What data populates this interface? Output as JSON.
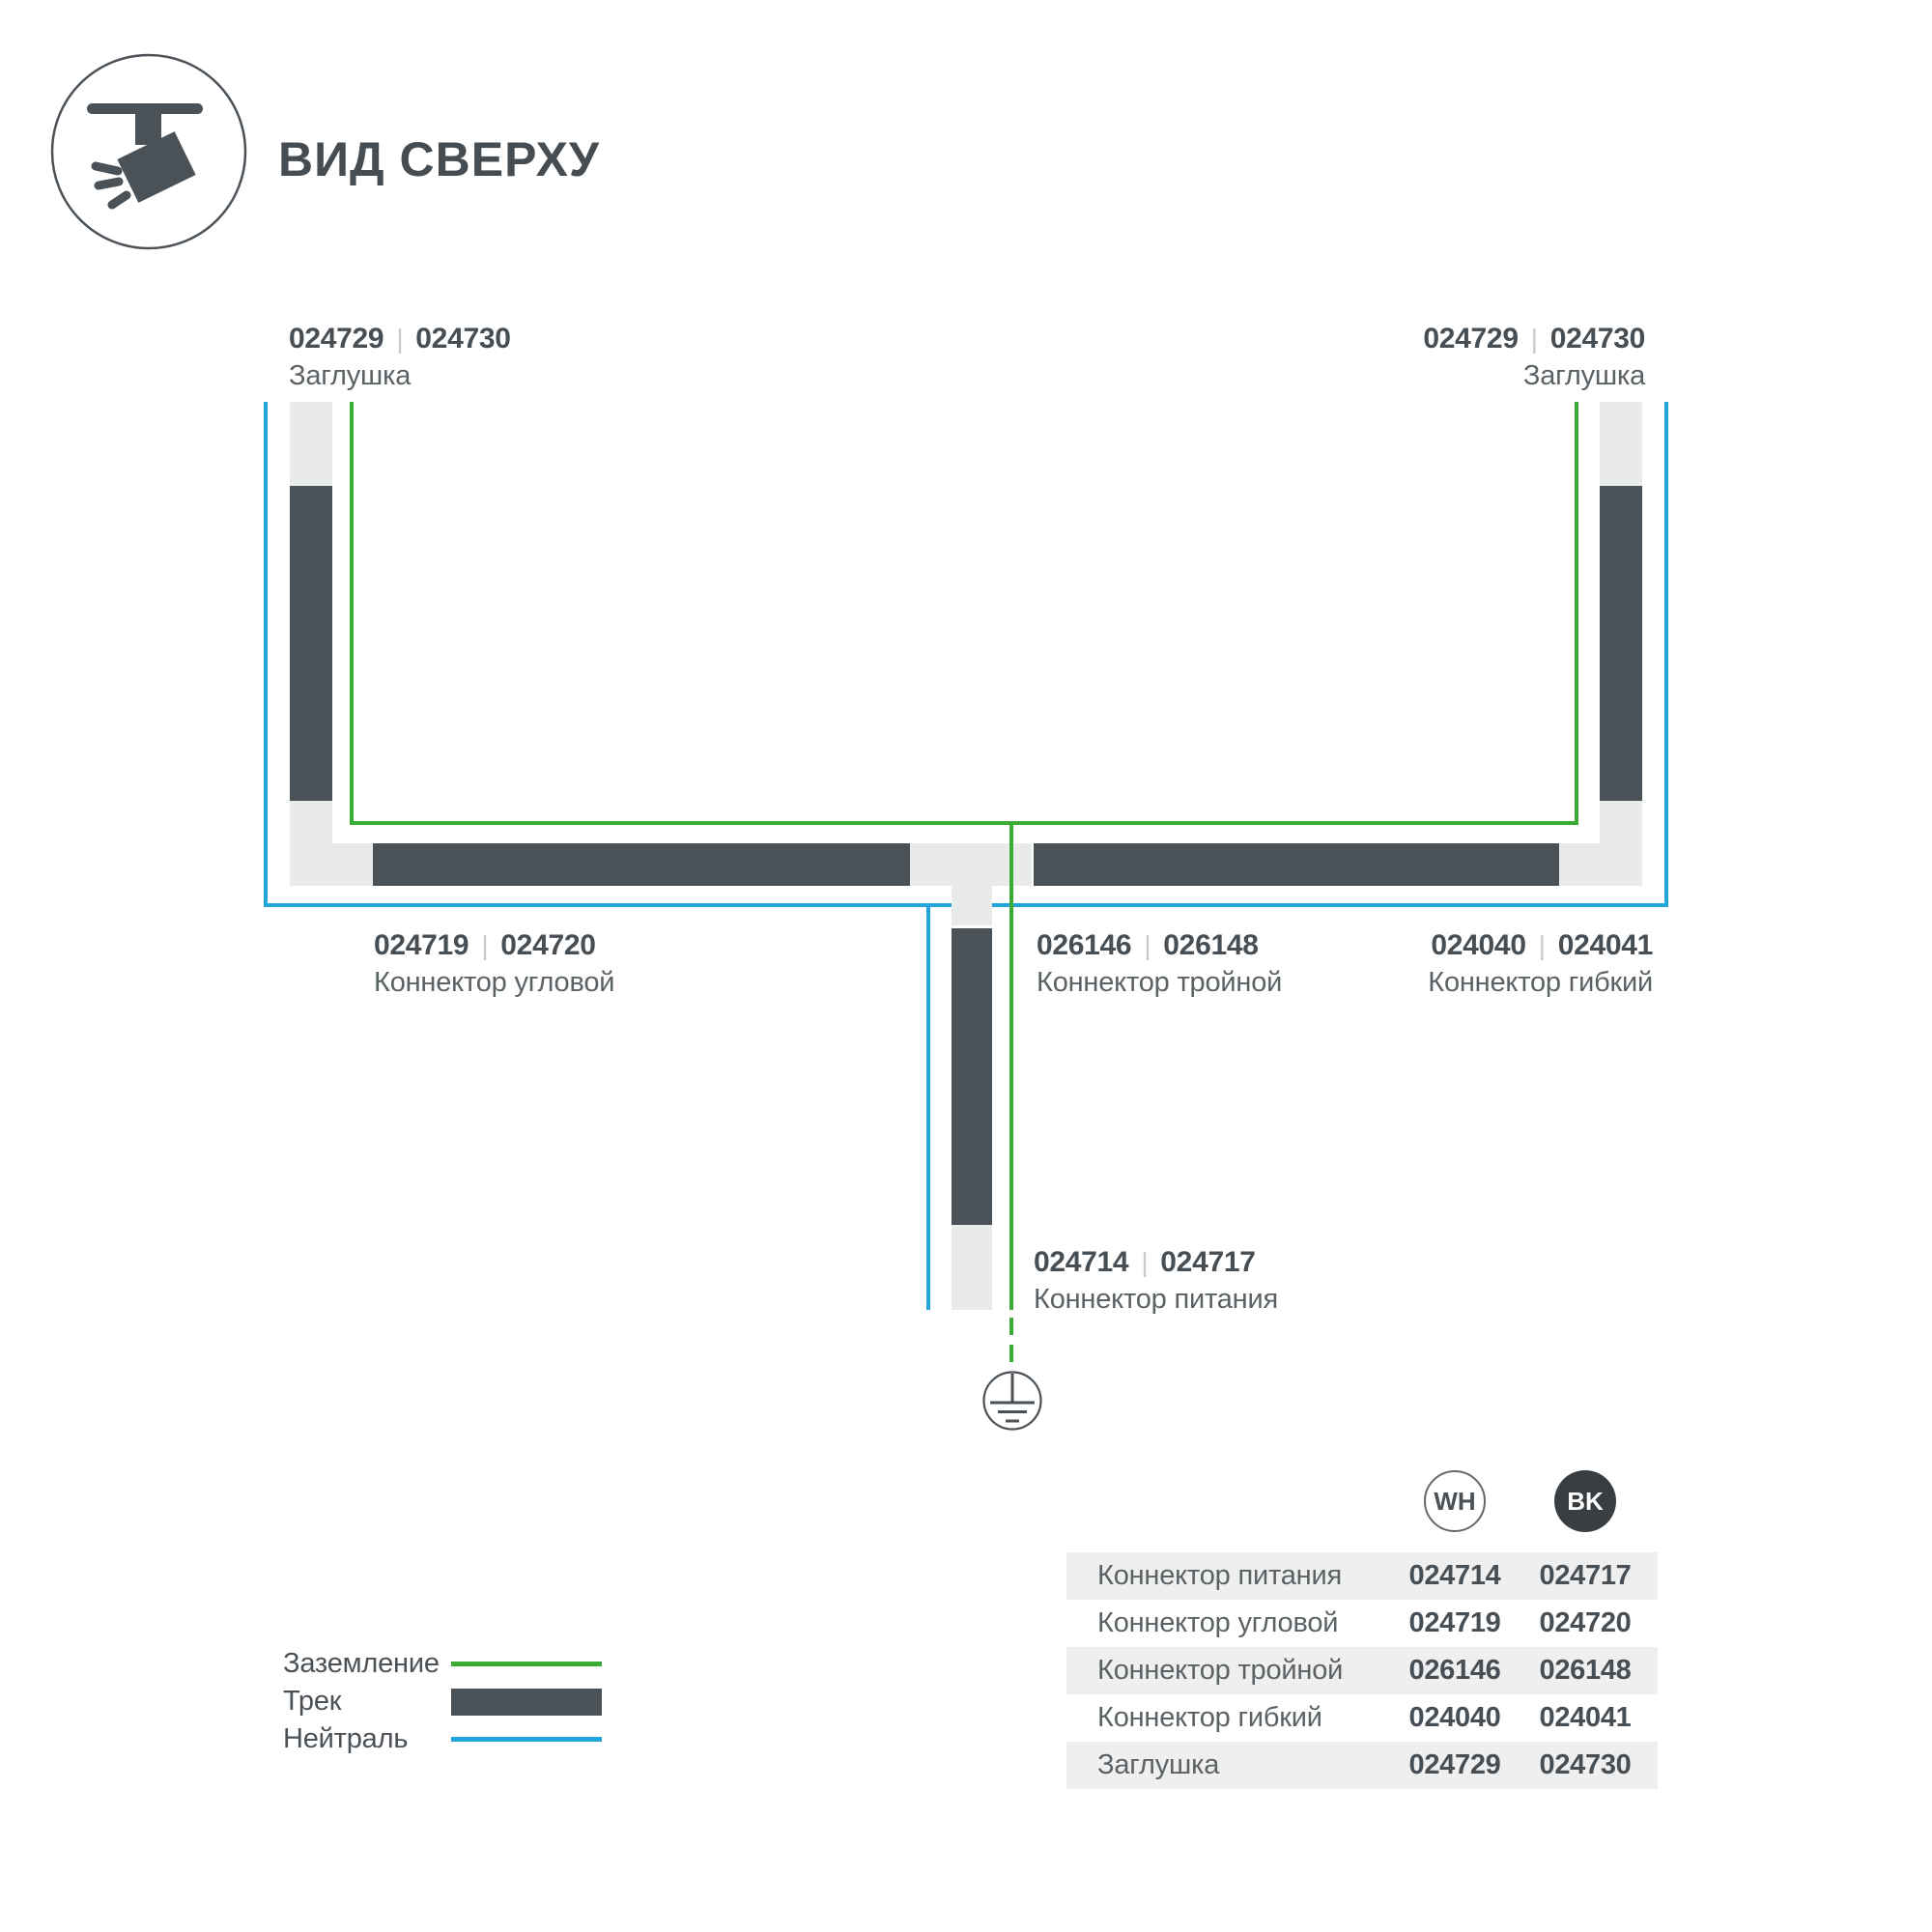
{
  "header": {
    "title": "ВИД СВЕРХУ"
  },
  "separator": "|",
  "parts": {
    "endcap_left": {
      "wh": "024729",
      "bk": "024730",
      "name": "Заглушка"
    },
    "endcap_right": {
      "wh": "024729",
      "bk": "024730",
      "name": "Заглушка"
    },
    "corner": {
      "wh": "024719",
      "bk": "024720",
      "name": "Коннектор угловой"
    },
    "triple": {
      "wh": "026146",
      "bk": "026148",
      "name": "Коннектор тройной"
    },
    "flex": {
      "wh": "024040",
      "bk": "024041",
      "name": "Коннектор гибкий"
    },
    "power": {
      "wh": "024714",
      "bk": "024717",
      "name": "Коннектор питания"
    }
  },
  "legend": {
    "items": [
      {
        "label": "Заземление",
        "swatch": "ground-line",
        "color": "#3BAB35"
      },
      {
        "label": "Трек",
        "swatch": "track-bar",
        "color": "#4A5157"
      },
      {
        "label": "Нейтраль",
        "swatch": "neutral-line",
        "color": "#24A4DC"
      }
    ]
  },
  "table": {
    "columns": [
      {
        "code": "WH"
      },
      {
        "code": "BK"
      }
    ],
    "rows": [
      {
        "name": "Коннектор питания",
        "wh": "024714",
        "bk": "024717"
      },
      {
        "name": "Коннектор угловой",
        "wh": "024719",
        "bk": "024720"
      },
      {
        "name": "Коннектор тройной",
        "wh": "026146",
        "bk": "026148"
      },
      {
        "name": "Коннектор гибкий",
        "wh": "024040",
        "bk": "024041"
      },
      {
        "name": "Заглушка",
        "wh": "024729",
        "bk": "024730"
      }
    ]
  },
  "colors": {
    "track": "#4A5157",
    "connector": "#E9EBEB",
    "ground_line": "#3BAB35",
    "neutral_line": "#24A4DC",
    "table_stripe": "#EFEFEF",
    "bk_badge": "#393E42"
  }
}
